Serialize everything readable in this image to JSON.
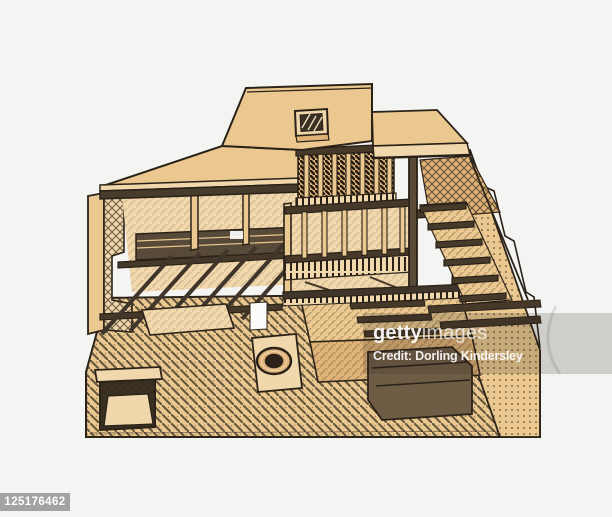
{
  "watermark": {
    "brand_bold": "getty",
    "brand_regular": "images",
    "credit": "Credit: Dorling Kindersley"
  },
  "image_id_badge": "125176462",
  "illustration": {
    "alt": "Cross-section illustration of house showing timber stud framing, floor joists, staircase, drain and foundations"
  },
  "colors": {
    "background": "#f4f4f2",
    "wash_light": "#f1d7ac",
    "wash_mid": "#eac88f",
    "wash_deep": "#dfb377",
    "ink": "#2a2218",
    "timber_dark": "#46392a",
    "watermark_overlay": "rgba(40,36,30,0.18)",
    "watermark_text": "#ffffff",
    "badge_background": "#a3a3a3",
    "badge_text": "#ffffff"
  }
}
